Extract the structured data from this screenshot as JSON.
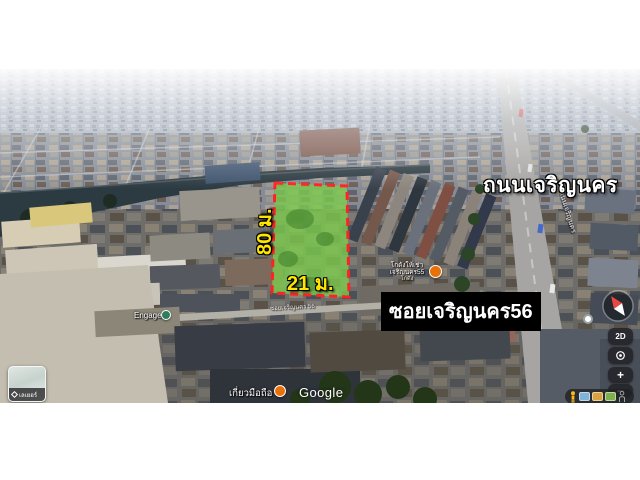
{
  "annotations": {
    "depth_label": "80 ม.",
    "width_label": "21 ม.",
    "main_road_label": "ถนนเจริญนคร",
    "soi_label": "ซอยเจริญนคร56",
    "highlight_fill": "#7ccb4e",
    "highlight_border": "#ff2222",
    "dimension_color": "#ffe600"
  },
  "map": {
    "street_label_main_road": "ถนนเจริญนคร",
    "street_label_soi": "ซอยเจริญนคร 56",
    "google_logo": "Google",
    "pois": {
      "warehouse": {
        "line1": "โกดังให้เช่า",
        "line2": "เจริญนคร55",
        "line3": "โกดัง"
      },
      "engage": {
        "label": "Engage"
      },
      "shop": {
        "label": "เกี่ยวมือถือ"
      }
    }
  },
  "controls": {
    "layers": {
      "label": "เลเยอร์"
    },
    "mode_2d": {
      "label": "2D"
    },
    "zoom_in": {
      "label": "+"
    },
    "zoom_out": {
      "label": "−"
    }
  }
}
